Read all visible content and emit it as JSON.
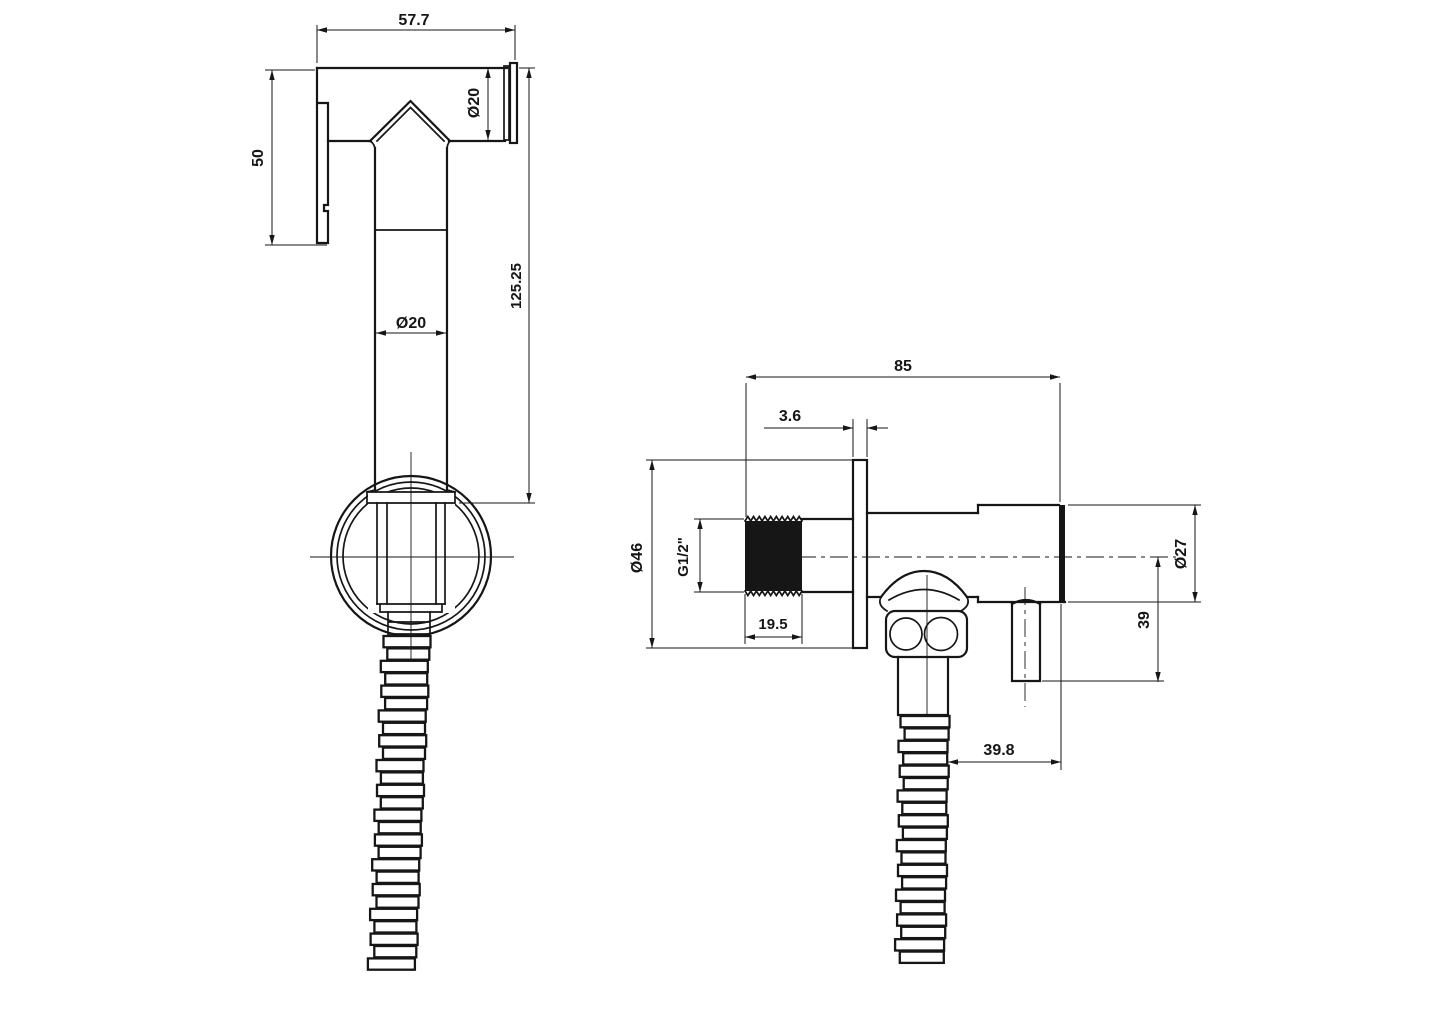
{
  "drawing": {
    "colors": {
      "line": "#161616",
      "background": "#ffffff"
    },
    "views": [
      {
        "id": "hand-sprayer-side-view",
        "dimensions": {
          "head_length": "57.7",
          "nozzle_diameter": "Ø20",
          "head_height": "50",
          "handle_length": "125.25",
          "handle_diameter": "Ø20"
        }
      },
      {
        "id": "angle-valve-front-view",
        "dimensions": {
          "overall_length": "85",
          "flange_thickness": "3.6",
          "flange_diameter": "Ø46",
          "inlet_thread": "G1/2\"",
          "thread_length": "19.5",
          "knob_diameter": "Ø27",
          "outlet_drop": "39",
          "hose_offset": "39.8"
        }
      }
    ]
  }
}
